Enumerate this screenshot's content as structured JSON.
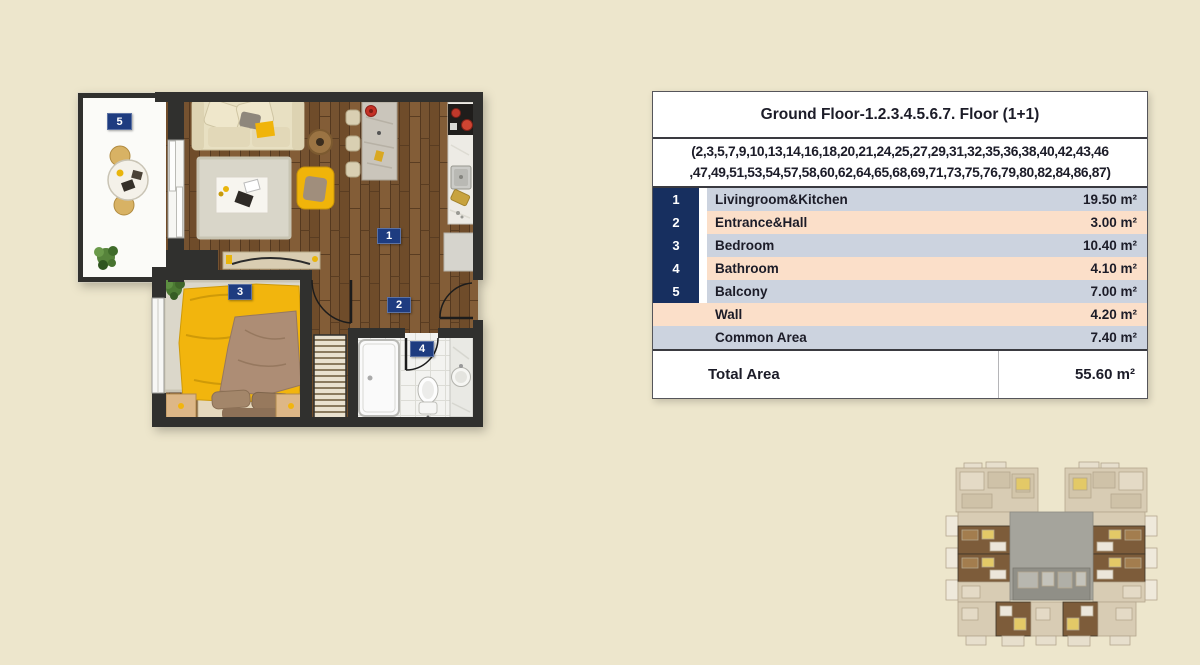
{
  "table": {
    "title": "Ground Floor-1.2.3.4.5.6.7. Floor (1+1)",
    "units_line1": "(2,3,5,7,9,10,13,14,16,18,20,21,24,25,27,29,31,32,35,36,38,40,42,43,46",
    "units_line2": ",47,49,51,53,54,57,58,60,62,64,65,68,69,71,73,75,76,79,80,82,84,86,87)",
    "rows": [
      {
        "num": "1",
        "label": "Livingroom&Kitchen",
        "area": "19.50 m²"
      },
      {
        "num": "2",
        "label": "Entrance&Hall",
        "area": "3.00 m²"
      },
      {
        "num": "3",
        "label": "Bedroom",
        "area": "10.40 m²"
      },
      {
        "num": "4",
        "label": "Bathroom",
        "area": "4.10 m²"
      },
      {
        "num": "5",
        "label": "Balcony",
        "area": "7.00 m²"
      },
      {
        "num": "",
        "label": "Wall",
        "area": "4.20 m²"
      },
      {
        "num": "",
        "label": "Common Area",
        "area": "7.40 m²"
      }
    ],
    "total_label": "Total Area",
    "total_area": "55.60 m²"
  },
  "floorplan": {
    "room_numbers": [
      "1",
      "2",
      "3",
      "4",
      "5"
    ],
    "legend": {
      "1": "Livingroom&Kitchen",
      "2": "Entrance&Hall",
      "3": "Bedroom",
      "4": "Bathroom",
      "5": "Balcony"
    }
  },
  "colors": {
    "page_background": "#ede6cc",
    "table_number_column": "#172f5f",
    "table_row_blue": "#ccd3df",
    "table_row_peach": "#fbdfc9",
    "room_label_navy": "#1e3c80",
    "wall_dark": "#30302e",
    "wood_floor": "#7a5632",
    "accent_yellow": "#f0b40a"
  }
}
